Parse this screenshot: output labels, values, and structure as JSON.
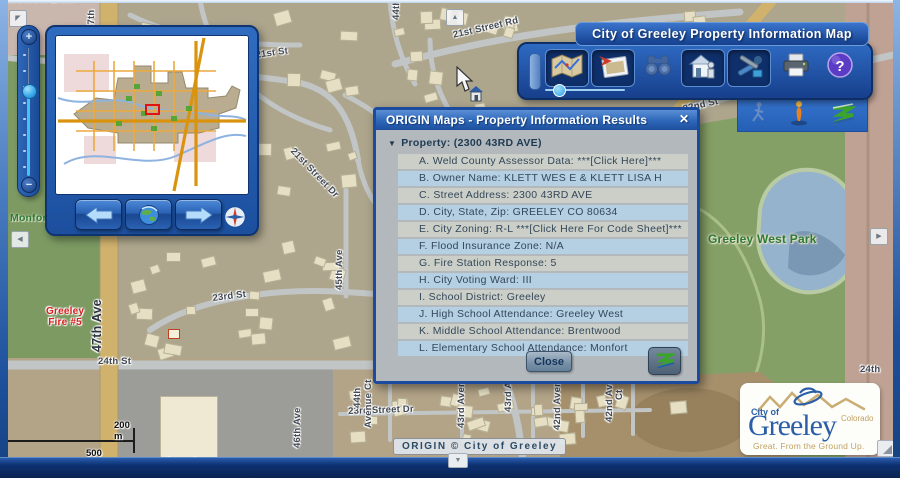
{
  "toolbar": {
    "title": "City of Greeley Property Information Map",
    "icons": [
      "map-icon",
      "aerial-photo-icon",
      "binoculars-icon",
      "house-info-icon",
      "tools-icon",
      "printer-icon",
      "help-icon"
    ],
    "accent_color": "#1d4f9e"
  },
  "sub_toolbar": {
    "icons": [
      "walking-person-icon",
      "person-icon",
      "origin-z-icon"
    ]
  },
  "dialog": {
    "title": "ORIGIN Maps - Property Information Results",
    "close_glyph": "✕",
    "property_header": "Property:  (2300 43RD AVE)",
    "rows": [
      {
        "text": "A. Weld County Assessor Data:  ***[Click Here]***"
      },
      {
        "text": "B. Owner Name:  KLETT WES E & KLETT LISA H"
      },
      {
        "text": "C. Street Address:  2300 43RD AVE"
      },
      {
        "text": "D. City, State, Zip:  GREELEY CO 80634"
      },
      {
        "text": "E. City Zoning:  R-L   ***[Click Here For Code Sheet]***"
      },
      {
        "text": "F. Flood Insurance Zone:  N/A"
      },
      {
        "text": "G. Fire Station Response:  5"
      },
      {
        "text": "H. City Voting Ward:  III"
      },
      {
        "text": "I. School District:  Greeley"
      },
      {
        "text": "J. High School Attendance:  Greeley West"
      },
      {
        "text": "K. Middle School Attendance:  Brentwood"
      },
      {
        "text": "L. Elementary School Attendance:  Monfort"
      }
    ],
    "close_button": "Close"
  },
  "map": {
    "attribution": "ORIGIN © City of Greeley",
    "scale": {
      "metric": "200 m",
      "imperial": "500 ft"
    },
    "labels": [
      {
        "text": "Monfort Elem",
        "x": 8,
        "y": -6,
        "rot": 0,
        "cls": "cut"
      },
      {
        "text": "47th",
        "x": 86,
        "y": 30,
        "rot": -90
      },
      {
        "text": "21st St",
        "x": 255,
        "y": 50,
        "rot": -8
      },
      {
        "text": "44th Ave",
        "x": 391,
        "y": 20,
        "rot": -90
      },
      {
        "text": "21st Street Rd",
        "x": 452,
        "y": 30,
        "rot": -13
      },
      {
        "text": "22nd St",
        "x": 682,
        "y": 104,
        "rot": -13
      },
      {
        "text": "21st Street Dr",
        "x": 296,
        "y": 146,
        "rot": 46
      },
      {
        "text": "45th Ave",
        "x": 334,
        "y": 290,
        "rot": -90
      },
      {
        "text": "23rd St",
        "x": 212,
        "y": 293,
        "rot": -7
      },
      {
        "text": "47th Ave",
        "x": 90,
        "y": 352,
        "rot": -90,
        "cls": "street-big"
      },
      {
        "text": "Greeley\nFire #5",
        "x": 46,
        "y": 306,
        "rot": 0,
        "cls": "red-bold"
      },
      {
        "text": "24th St",
        "x": 98,
        "y": 356,
        "rot": 0
      },
      {
        "text": "Lowe's",
        "x": 168,
        "y": 456,
        "rot": 0,
        "cls": "dark"
      },
      {
        "text": "46th Ave",
        "x": 292,
        "y": 448,
        "rot": -90
      },
      {
        "text": "23rd Street Dr",
        "x": 348,
        "y": 406,
        "rot": -2
      },
      {
        "text": "44th",
        "x": 352,
        "y": 408,
        "rot": -90
      },
      {
        "text": "Avenue Ct",
        "x": 363,
        "y": 428,
        "rot": -90
      },
      {
        "text": "43rd Avenue",
        "x": 456,
        "y": 428,
        "rot": -90
      },
      {
        "text": "43rd Av",
        "x": 503,
        "y": 412,
        "rot": -90
      },
      {
        "text": "42nd Avenue",
        "x": 552,
        "y": 430,
        "rot": -90
      },
      {
        "text": "42nd Av",
        "x": 604,
        "y": 422,
        "rot": -90
      },
      {
        "text": "Ct",
        "x": 614,
        "y": 400,
        "rot": -90
      },
      {
        "text": "Greeley West Park",
        "x": 708,
        "y": 232,
        "rot": 0,
        "cls": "park"
      },
      {
        "text": "Monfort",
        "x": 10,
        "y": 212,
        "rot": 0,
        "cls": "park-sm"
      },
      {
        "text": "24th",
        "x": 860,
        "y": 364,
        "rot": 0
      }
    ]
  },
  "logo": {
    "city_of": "City of",
    "name": "Greeley",
    "state": "Colorado",
    "tagline": "Great. From the Ground Up."
  }
}
